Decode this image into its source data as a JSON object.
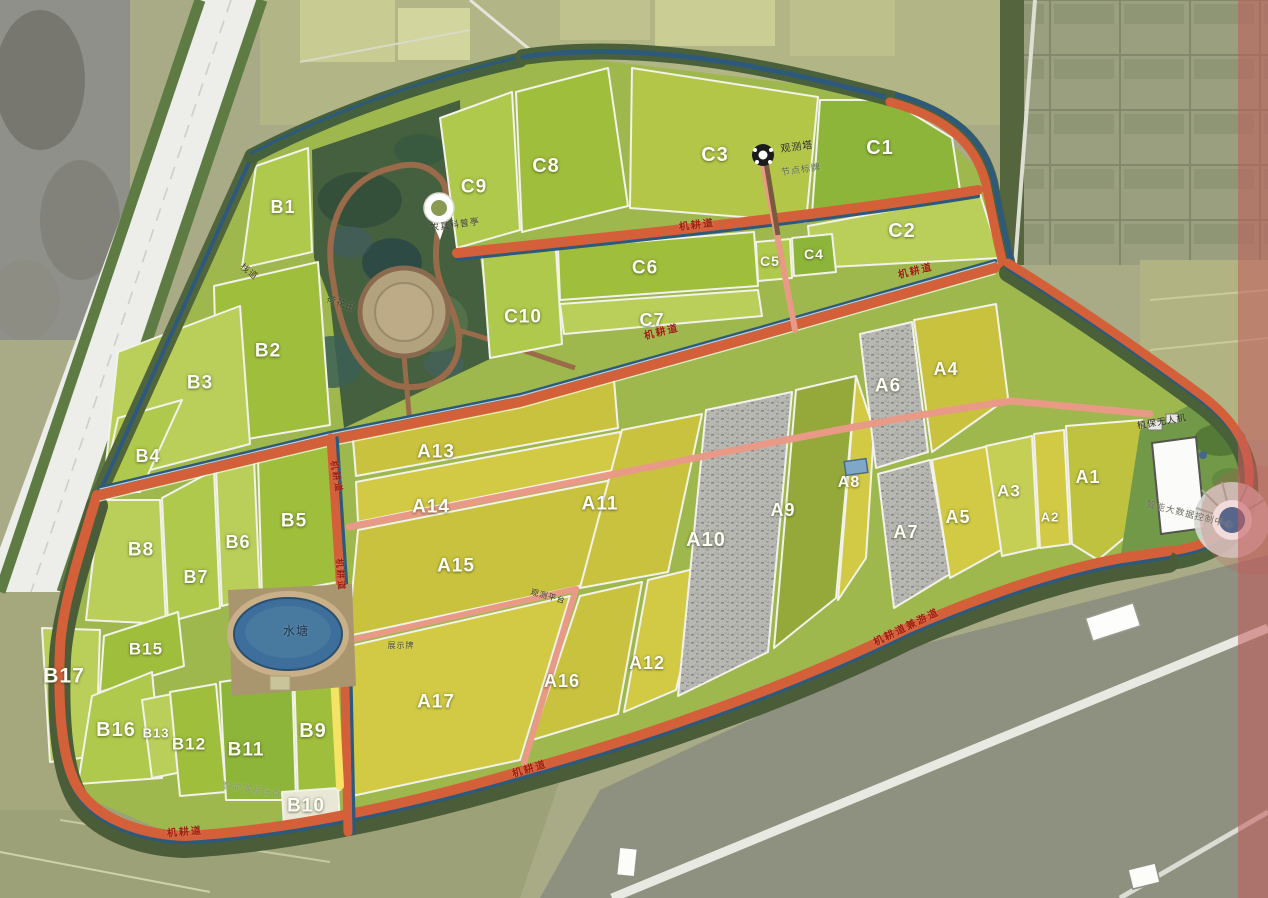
{
  "palette": {
    "road_red": "#d4603a",
    "road_salmon": "#e89a86",
    "canal_blue": "#2d5a7c",
    "tree_green": "#4b5c39",
    "field_gold": "#c9c23e",
    "field_green": "#9fbe3c",
    "gravel_gray": "#b8b8b2",
    "pond_blue": "#3e6e9c",
    "path_yellow": "#f5e464",
    "overlay_pink": "#c35b5b",
    "road_label_red": "#9c1f0e"
  },
  "plot_labels": [
    {
      "id": "c1",
      "label": "C1",
      "x": 880,
      "y": 148,
      "size": 20
    },
    {
      "id": "c2",
      "label": "C2",
      "x": 902,
      "y": 231,
      "size": 20
    },
    {
      "id": "c3",
      "label": "C3",
      "x": 715,
      "y": 155,
      "size": 20
    },
    {
      "id": "c4",
      "label": "C4",
      "x": 814,
      "y": 254,
      "size": 14
    },
    {
      "id": "c5",
      "label": "C5",
      "x": 770,
      "y": 261,
      "size": 14
    },
    {
      "id": "c6",
      "label": "C6",
      "x": 645,
      "y": 268,
      "size": 19
    },
    {
      "id": "c7",
      "label": "C7",
      "x": 652,
      "y": 320,
      "size": 18
    },
    {
      "id": "c8",
      "label": "C8",
      "x": 546,
      "y": 166,
      "size": 20
    },
    {
      "id": "c9",
      "label": "C9",
      "x": 474,
      "y": 187,
      "size": 19
    },
    {
      "id": "c10",
      "label": "C10",
      "x": 523,
      "y": 317,
      "size": 19
    },
    {
      "id": "b1",
      "label": "B1",
      "x": 283,
      "y": 207,
      "size": 18
    },
    {
      "id": "b2",
      "label": "B2",
      "x": 268,
      "y": 351,
      "size": 19
    },
    {
      "id": "b3",
      "label": "B3",
      "x": 200,
      "y": 383,
      "size": 19
    },
    {
      "id": "b4",
      "label": "B4",
      "x": 148,
      "y": 456,
      "size": 18
    },
    {
      "id": "b5",
      "label": "B5",
      "x": 294,
      "y": 521,
      "size": 19
    },
    {
      "id": "b6",
      "label": "B6",
      "x": 238,
      "y": 542,
      "size": 18
    },
    {
      "id": "b7",
      "label": "B7",
      "x": 196,
      "y": 577,
      "size": 18
    },
    {
      "id": "b8",
      "label": "B8",
      "x": 141,
      "y": 550,
      "size": 19
    },
    {
      "id": "b9",
      "label": "B9",
      "x": 313,
      "y": 731,
      "size": 20
    },
    {
      "id": "b10",
      "label": "B10",
      "x": 306,
      "y": 806,
      "size": 19
    },
    {
      "id": "b11",
      "label": "B11",
      "x": 246,
      "y": 750,
      "size": 19
    },
    {
      "id": "b12",
      "label": "B12",
      "x": 189,
      "y": 744,
      "size": 17
    },
    {
      "id": "b13",
      "label": "B13",
      "x": 156,
      "y": 733,
      "size": 13
    },
    {
      "id": "b15",
      "label": "B15",
      "x": 146,
      "y": 649,
      "size": 17
    },
    {
      "id": "b16",
      "label": "B16",
      "x": 116,
      "y": 730,
      "size": 20
    },
    {
      "id": "b17",
      "label": "B17",
      "x": 64,
      "y": 676,
      "size": 21
    },
    {
      "id": "a1",
      "label": "A1",
      "x": 1088,
      "y": 477,
      "size": 18
    },
    {
      "id": "a2",
      "label": "A2",
      "x": 1050,
      "y": 517,
      "size": 13
    },
    {
      "id": "a3",
      "label": "A3",
      "x": 1009,
      "y": 491,
      "size": 17
    },
    {
      "id": "a4",
      "label": "A4",
      "x": 946,
      "y": 369,
      "size": 18
    },
    {
      "id": "a5",
      "label": "A5",
      "x": 958,
      "y": 517,
      "size": 18
    },
    {
      "id": "a6",
      "label": "A6",
      "x": 888,
      "y": 386,
      "size": 19
    },
    {
      "id": "a7",
      "label": "A7",
      "x": 906,
      "y": 532,
      "size": 18
    },
    {
      "id": "a8",
      "label": "A8",
      "x": 849,
      "y": 483,
      "size": 16
    },
    {
      "id": "a9",
      "label": "A9",
      "x": 783,
      "y": 510,
      "size": 18
    },
    {
      "id": "a10",
      "label": "A10",
      "x": 706,
      "y": 540,
      "size": 20
    },
    {
      "id": "a11",
      "label": "A11",
      "x": 600,
      "y": 504,
      "size": 19
    },
    {
      "id": "a12",
      "label": "A12",
      "x": 647,
      "y": 663,
      "size": 18
    },
    {
      "id": "a13",
      "label": "A13",
      "x": 436,
      "y": 452,
      "size": 19
    },
    {
      "id": "a14",
      "label": "A14",
      "x": 431,
      "y": 507,
      "size": 19
    },
    {
      "id": "a15",
      "label": "A15",
      "x": 456,
      "y": 566,
      "size": 19
    },
    {
      "id": "a16",
      "label": "A16",
      "x": 562,
      "y": 681,
      "size": 18
    },
    {
      "id": "a17",
      "label": "A17",
      "x": 436,
      "y": 702,
      "size": 19
    }
  ],
  "road_labels": [
    {
      "name": "road-label-top",
      "text": "机耕道",
      "x": 697,
      "y": 226,
      "rot": -7,
      "size": 10
    },
    {
      "name": "road-label-northeast",
      "text": "机耕道",
      "x": 916,
      "y": 272,
      "rot": -14,
      "size": 10
    },
    {
      "name": "road-label-main",
      "text": "机耕道",
      "x": 662,
      "y": 333,
      "rot": -14,
      "size": 10
    },
    {
      "name": "road-label-south-tour",
      "text": "机耕道兼游道",
      "x": 907,
      "y": 628,
      "rot": -26,
      "size": 10
    },
    {
      "name": "road-label-south",
      "text": "机耕道",
      "x": 530,
      "y": 770,
      "rot": -17,
      "size": 10
    },
    {
      "name": "road-label-southwest",
      "text": "机耕道",
      "x": 185,
      "y": 833,
      "rot": -5,
      "size": 10
    },
    {
      "name": "road-label-vertical-1",
      "text": "机耕道",
      "x": 340,
      "y": 575,
      "rot": 85,
      "size": 9
    },
    {
      "name": "road-label-vertical-2",
      "text": "机耕道",
      "x": 336,
      "y": 477,
      "rot": 80,
      "size": 9
    }
  ],
  "feature_labels": [
    {
      "name": "observation-tower-label",
      "text": "观测塔",
      "x": 797,
      "y": 148,
      "rot": -8,
      "size": 10,
      "color": "#26261e"
    },
    {
      "name": "node-sign-label",
      "text": "节点标牌",
      "x": 801,
      "y": 170,
      "rot": -8,
      "size": 9,
      "color": "#5c6b54"
    },
    {
      "name": "farm-tool-pavilion-label",
      "text": "农具科普亭",
      "x": 455,
      "y": 225,
      "rot": -8,
      "size": 9,
      "color": "#3a3a30"
    },
    {
      "name": "boardwalk-label",
      "text": "栈道",
      "x": 249,
      "y": 272,
      "rot": 38,
      "size": 9,
      "color": "#4a3a28"
    },
    {
      "name": "lotus-field-label",
      "text": "荷花田",
      "x": 341,
      "y": 304,
      "rot": 20,
      "size": 9,
      "color": "#39482c"
    },
    {
      "name": "pond-label",
      "text": "水塘",
      "x": 296,
      "y": 631,
      "rot": 0,
      "size": 12,
      "color": "#16324a"
    },
    {
      "name": "observation-platform-label",
      "text": "观测平台",
      "x": 548,
      "y": 597,
      "rot": 15,
      "size": 8,
      "color": "#33332a"
    },
    {
      "name": "display-board-label",
      "text": "展示牌",
      "x": 401,
      "y": 646,
      "rot": 0,
      "size": 8,
      "color": "#4c4c40"
    },
    {
      "name": "drone-label",
      "text": "植保无人机",
      "x": 1162,
      "y": 422,
      "rot": -10,
      "size": 9,
      "color": "#2e2e26"
    },
    {
      "name": "control-center-label",
      "text": "智能大数据控制中心",
      "x": 1190,
      "y": 515,
      "rot": 14,
      "size": 9,
      "color": "#6d6d63"
    },
    {
      "name": "smart-irrigation-label",
      "text": "智能灌溉设备",
      "x": 252,
      "y": 790,
      "rot": 8,
      "size": 9,
      "color": "#8a9a6a"
    }
  ]
}
